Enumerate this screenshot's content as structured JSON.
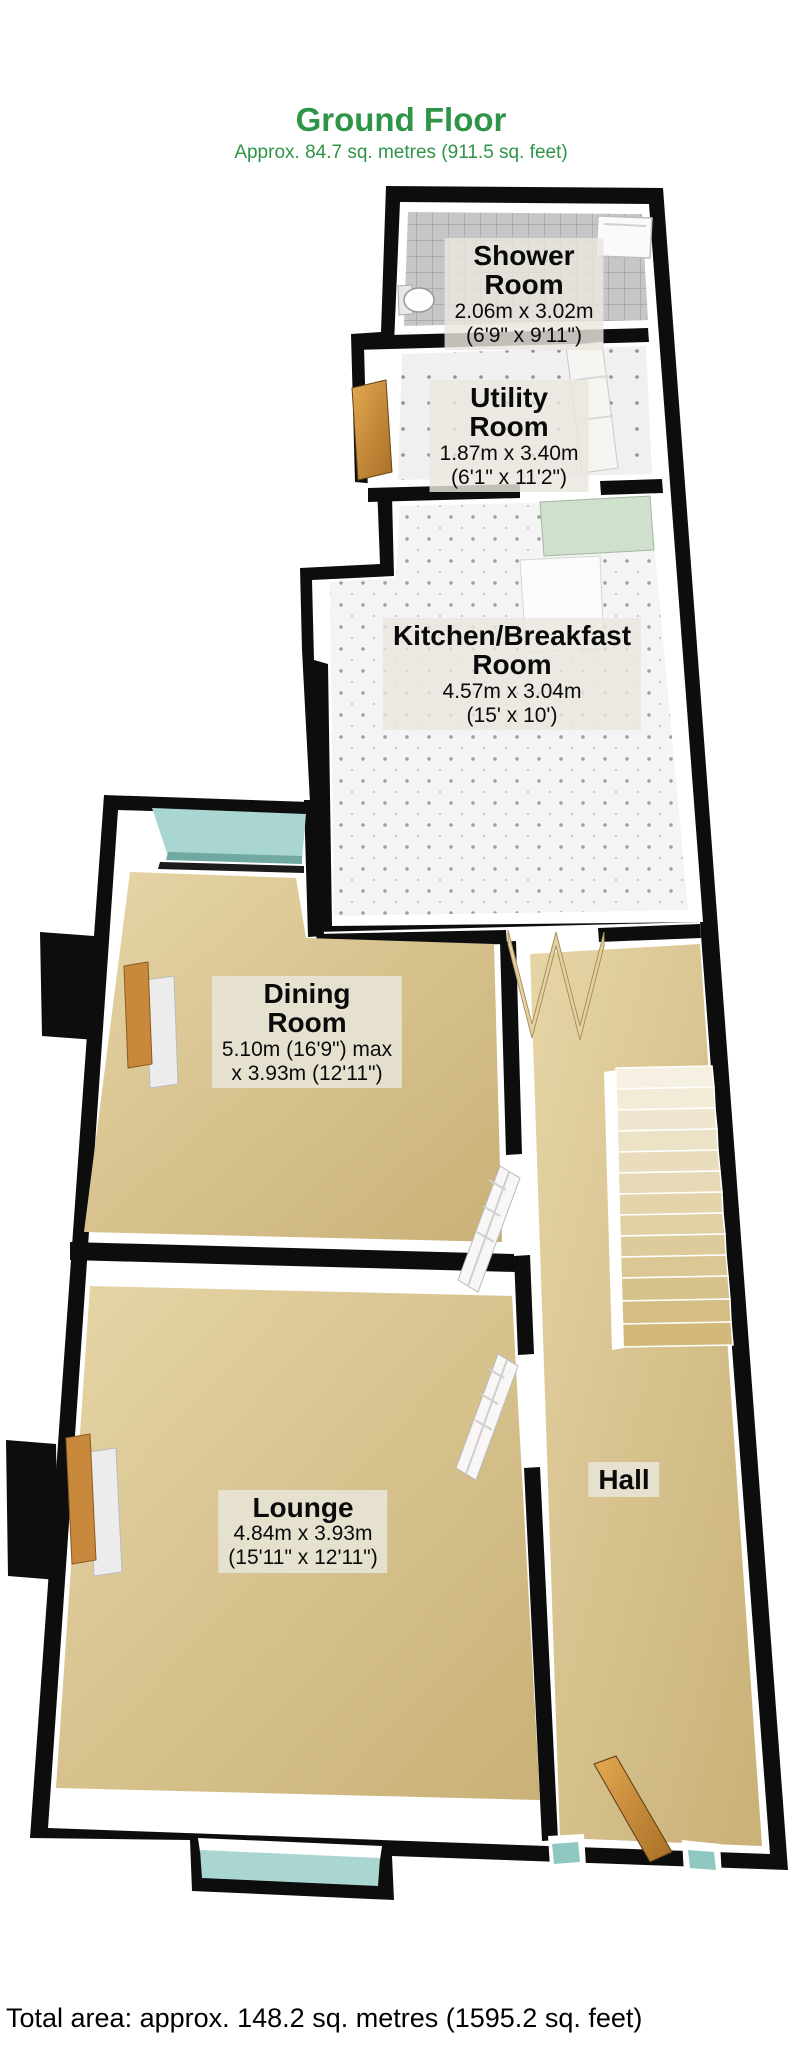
{
  "header": {
    "title": "Ground Floor",
    "subtitle": "Approx. 84.7 sq. metres (911.5 sq. feet)"
  },
  "rooms": {
    "shower": {
      "line1": "Shower",
      "line2": "Room",
      "dim_metric": "2.06m x 3.02m",
      "dim_imperial": "(6'9\" x 9'11\")"
    },
    "utility": {
      "line1": "Utility",
      "line2": "Room",
      "dim_metric": "1.87m x 3.40m",
      "dim_imperial": "(6'1\" x 11'2\")"
    },
    "kitchen": {
      "line1": "Kitchen/Breakfast",
      "line2": "Room",
      "dim_metric": "4.57m x 3.04m",
      "dim_imperial": "(15' x 10')"
    },
    "dining": {
      "line1": "Dining",
      "line2": "Room",
      "dim_metric": "5.10m (16'9\") max",
      "dim_imperial": "x 3.93m (12'11\")"
    },
    "lounge": {
      "line1": "Lounge",
      "dim_metric": "4.84m x 3.93m",
      "dim_imperial": "(15'11\" x 12'11\")"
    },
    "hall": {
      "line1": "Hall"
    }
  },
  "footer": {
    "total_area": "Total area: approx. 148.2 sq. metres (1595.2 sq. feet)"
  },
  "colors": {
    "accent_green": "#2e9447",
    "wall_black": "#0d0d0d",
    "carpet_tan": "#d7c28e",
    "window_glass_teal": "#a9d6d0",
    "door_wood": "#c8893c",
    "label_background": "rgba(233,230,221,0.82)"
  }
}
